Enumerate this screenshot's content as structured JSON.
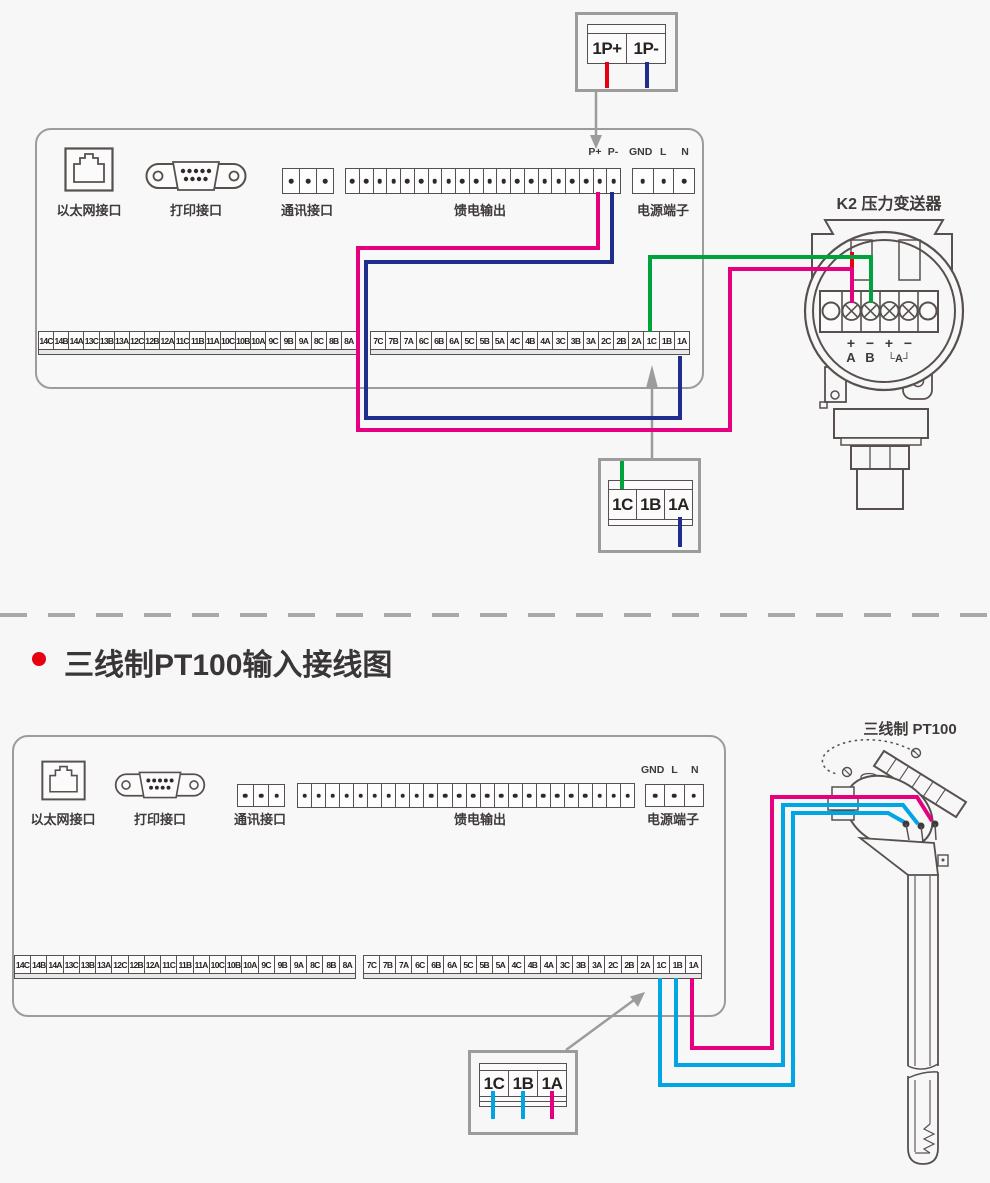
{
  "colors": {
    "red": "#e60012",
    "navy": "#1f2d8c",
    "magenta": "#e5007f",
    "green": "#00a23c",
    "cyan": "#00a5e3",
    "arrow_gray": "#9c9c9c",
    "outline": "#57504e",
    "text": "#3e3a39",
    "bullet_red": "#e60012"
  },
  "strips": {
    "left": [
      "14C",
      "14B",
      "14A",
      "13C",
      "13B",
      "13A",
      "12C",
      "12B",
      "12A",
      "11C",
      "11B",
      "11A",
      "10C",
      "10B",
      "10A",
      "9C",
      "9B",
      "9A",
      "8C",
      "8B",
      "8A"
    ],
    "right": [
      "7C",
      "7B",
      "7A",
      "6C",
      "6B",
      "6A",
      "5C",
      "5B",
      "5A",
      "4C",
      "4B",
      "4A",
      "3C",
      "3B",
      "3A",
      "2C",
      "2B",
      "2A",
      "1C",
      "1B",
      "1A"
    ]
  },
  "top_section": {
    "signal_box": {
      "cells": [
        "1P+",
        "1P-"
      ]
    },
    "panel": {
      "ethernet_label": "以太网接口",
      "printer_label": "打印接口",
      "comm_label": "通讯接口",
      "feed_label": "馈电输出",
      "power_label": "电源端子",
      "pplus": "P+",
      "pminus": "P-",
      "gnd": "GND",
      "line": "L",
      "neutral": "N",
      "feed_terminal_count": 20,
      "comm_terminal_count": 3,
      "power_terminal_count": 3
    },
    "transmitter": {
      "title": "K2  压力变送器",
      "polarity_labels": [
        "+",
        "−",
        "+",
        "−"
      ],
      "channel_labels": [
        "A",
        "B",
        "└A┘"
      ]
    },
    "channel_box": {
      "cells": [
        "1C",
        "1B",
        "1A"
      ]
    }
  },
  "section_divider_title": "三线制PT100输入接线图",
  "bottom_section": {
    "panel": {
      "ethernet_label": "以太网接口",
      "printer_label": "打印接口",
      "comm_label": "通讯接口",
      "feed_label": "馈电输出",
      "power_label": "电源端子",
      "gnd": "GND",
      "line": "L",
      "neutral": "N",
      "feed_terminal_count": 24,
      "comm_terminal_count": 3,
      "power_terminal_count": 3
    },
    "sensor": {
      "title": "三线制  PT100"
    },
    "channel_box": {
      "cells": [
        "1C",
        "1B",
        "1A"
      ]
    }
  }
}
